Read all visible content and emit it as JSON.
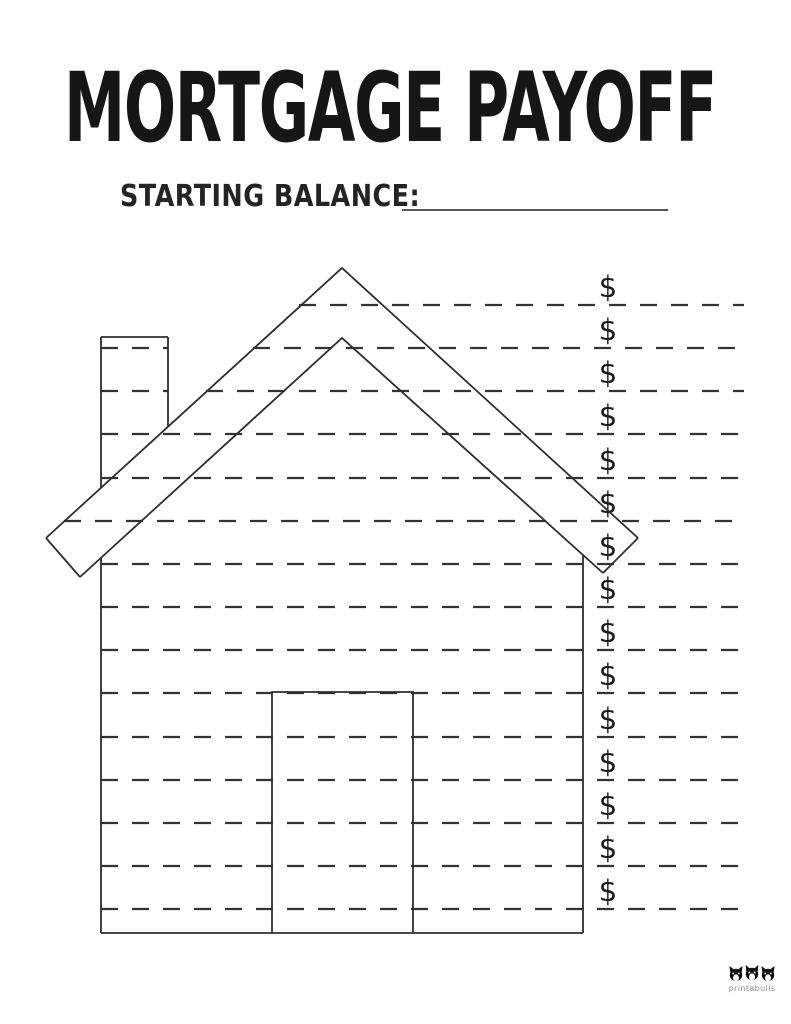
{
  "header": {
    "title": "MORTGAGE PAYOFF",
    "starting_balance_label": "STARTING BALANCE:",
    "starting_balance_value": ""
  },
  "payment_lines": {
    "count": 15,
    "currency_symbol": "$",
    "entries": [
      "",
      "",
      "",
      "",
      "",
      "",
      "",
      "",
      "",
      "",
      "",
      "",
      "",
      "",
      ""
    ]
  },
  "footer": {
    "brand": "printabulls"
  },
  "colors": {
    "ink": "#1f1f1f",
    "outline": "#2e2e2e",
    "dash_line": "#333333",
    "balance_underline": "#5a5a5a",
    "brand_text": "#8f8f8f"
  }
}
